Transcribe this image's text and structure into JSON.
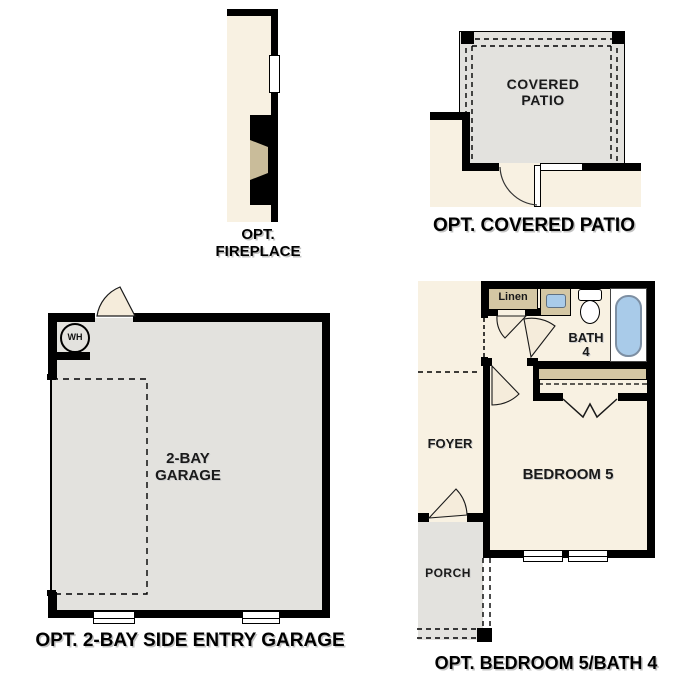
{
  "plan_options": {
    "fireplace": {
      "caption_line1": "OPT.",
      "caption_line2": "FIREPLACE"
    },
    "covered_patio": {
      "caption": "OPT. COVERED PATIO",
      "room_line1": "COVERED",
      "room_line2": "PATIO"
    },
    "garage": {
      "caption": "OPT. 2-BAY SIDE ENTRY GARAGE",
      "room_line1": "2-BAY",
      "room_line2": "GARAGE",
      "water_heater_label": "WH"
    },
    "bedroom5_bath4": {
      "caption": "OPT. BEDROOM 5/BATH 4",
      "foyer_label": "FOYER",
      "bedroom_label": "BEDROOM 5",
      "porch_label": "PORCH",
      "bath_line1": "BATH",
      "bath_line2": "4",
      "linen_label": "Linen"
    }
  },
  "colors": {
    "interior_cream": "#f8f1e2",
    "floor_gray": "#e3e2de",
    "casework_tan": "#d4c7a4",
    "firebox_tan": "#c9bc9a",
    "fixture_blue": "#a9cbe9",
    "wall_black": "#000000"
  }
}
